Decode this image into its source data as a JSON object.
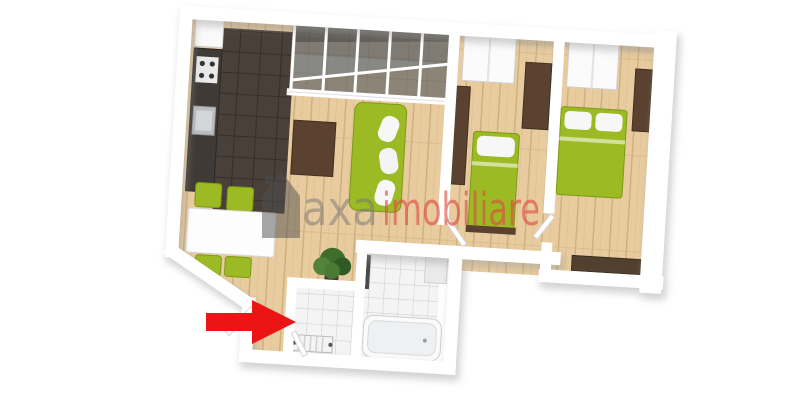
{
  "image": {
    "kind": "3d-apartment-floor-plan-render",
    "background": "#ffffff"
  },
  "watermark": {
    "logo": "house-icon",
    "logo_color": "#4d4d4d",
    "text_primary": "axa",
    "text_secondary": "imobiliare",
    "primary_color": "#757575",
    "secondary_color": "#df4a41"
  },
  "entrance": {
    "arrow_icon": "right-arrow-icon",
    "arrow_color": "#ec1515"
  },
  "palette": {
    "furniture_green": "#9cba23",
    "furniture_green_edge": "#7d9a15",
    "wood_floor": "#e8cc9f",
    "kitchen_tile": "#49403a",
    "bath_tile": "#f4f4f4",
    "wall": "#ffffff",
    "wood_furniture": "#5a4130",
    "wood_furniture_dark": "#42301f",
    "glass": "#8f9ca1",
    "plant_green": "#3f6d2c"
  },
  "rooms": {
    "kitchen": [
      "dark-tile-floor",
      "counter",
      "stove",
      "sink",
      "fridge"
    ],
    "dining": [
      "white-table",
      "four-green-chairs"
    ],
    "living": [
      "green-sofa",
      "tv-stand"
    ],
    "balcony": [
      "glass-enclosure"
    ],
    "bedroom1": [
      "green-single-bed",
      "closet",
      "wardrobe",
      "bookcase"
    ],
    "bedroom2": [
      "green-double-bed",
      "closet",
      "wardrobe",
      "sideboard"
    ],
    "hallway": [
      "potted-plant",
      "entrance-door"
    ],
    "wc": [
      "radiator"
    ],
    "bathroom": [
      "bathtub",
      "towel-rail",
      "washbasin"
    ]
  }
}
